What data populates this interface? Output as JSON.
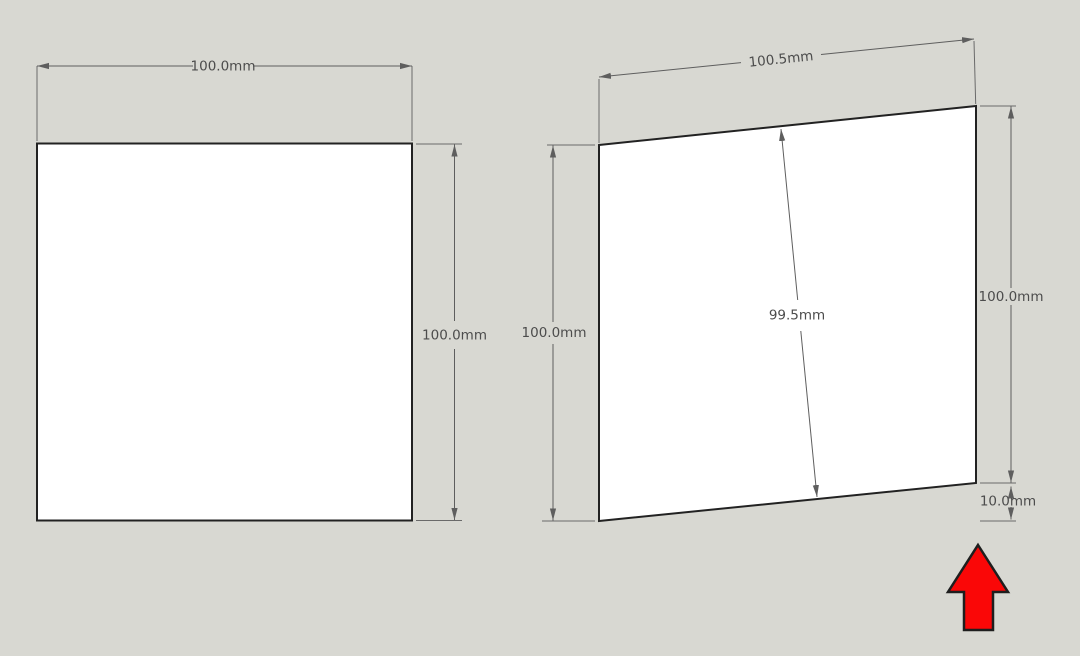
{
  "canvas": {
    "background_color": "#d8d8d2",
    "face_color": "#ffffff",
    "edge_color": "#222222",
    "dimension_line_color": "#5e5e5e",
    "dimension_text_color": "#4c4c4c"
  },
  "left_square": {
    "width_label": "100.0mm",
    "height_label": "100.0mm"
  },
  "right_square": {
    "top_width_label": "100.5mm",
    "left_height_label": "100.0mm",
    "right_height_label": "100.0mm",
    "center_height_label": "99.5mm",
    "corner_offset_label": "10.0mm"
  },
  "red_arrow": {
    "direction": "up",
    "fill_color": "#fa0707",
    "outline_color": "#1e1e1e"
  }
}
